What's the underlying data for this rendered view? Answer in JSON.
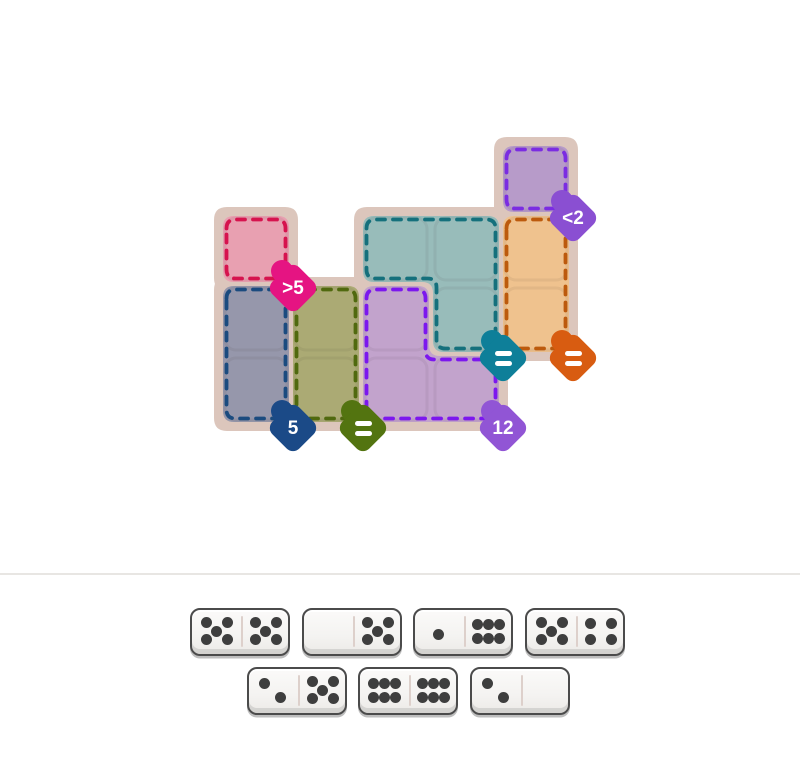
{
  "board": {
    "grid": {
      "origin_x": 221,
      "origin_y": 144,
      "cell": 70
    },
    "mat_color": "#dcc6bc",
    "regions": [
      {
        "id": "purple-top",
        "fill": "#b79bc9",
        "border": "#7b2ce2",
        "cells": [
          [
            4,
            0
          ]
        ],
        "badge": {
          "label": "<2",
          "color": "#8a4fd2",
          "corner": [
            5,
            1
          ]
        }
      },
      {
        "id": "pink",
        "fill": "#e8a0b1",
        "border": "#d6134e",
        "cells": [
          [
            0,
            1
          ]
        ],
        "badge": {
          "label": ">5",
          "color": "#e51482",
          "corner": [
            1,
            2
          ]
        }
      },
      {
        "id": "teal",
        "fill": "#98bcba",
        "border": "#15707c",
        "cells": [
          [
            2,
            1
          ],
          [
            3,
            1
          ],
          [
            3,
            2
          ]
        ],
        "badge": {
          "label": "=",
          "color": "#0e7f99",
          "corner": [
            4,
            3
          ]
        }
      },
      {
        "id": "orange",
        "fill": "#efc28e",
        "border": "#bc5a0d",
        "cells": [
          [
            4,
            1
          ],
          [
            4,
            2
          ]
        ],
        "badge": {
          "label": "=",
          "color": "#d85c11",
          "corner": [
            5,
            3
          ]
        }
      },
      {
        "id": "slate",
        "fill": "#9697ab",
        "border": "#1b4b7f",
        "cells": [
          [
            0,
            2
          ],
          [
            0,
            3
          ]
        ],
        "badge": {
          "label": "5",
          "color": "#1b4a87",
          "corner": [
            1,
            4
          ]
        }
      },
      {
        "id": "olive",
        "fill": "#abaa74",
        "border": "#50690f",
        "cells": [
          [
            1,
            2
          ],
          [
            1,
            3
          ]
        ],
        "badge": {
          "label": "=",
          "color": "#537410",
          "corner": [
            2,
            4
          ]
        }
      },
      {
        "id": "purple-l",
        "fill": "#c2a3cc",
        "border": "#7c17ee",
        "cells": [
          [
            2,
            2
          ],
          [
            2,
            3
          ],
          [
            3,
            3
          ]
        ],
        "badge": {
          "label": "12",
          "color": "#9155d5",
          "corner": [
            4,
            4
          ]
        }
      }
    ]
  },
  "tray": {
    "divider_color": "#e8e6e3",
    "pip_color": "#3e3e3e",
    "rows": [
      {
        "y": 608,
        "items": [
          {
            "x": 190,
            "pips": [
              5,
              5
            ]
          },
          {
            "x": 302,
            "pips": [
              0,
              5
            ]
          },
          {
            "x": 413,
            "pips": [
              1,
              6
            ]
          },
          {
            "x": 525,
            "pips": [
              5,
              4
            ]
          }
        ]
      },
      {
        "y": 667,
        "items": [
          {
            "x": 247,
            "pips": [
              2,
              5
            ]
          },
          {
            "x": 358,
            "pips": [
              6,
              6
            ]
          },
          {
            "x": 470,
            "pips": [
              2,
              0
            ]
          }
        ]
      }
    ]
  }
}
